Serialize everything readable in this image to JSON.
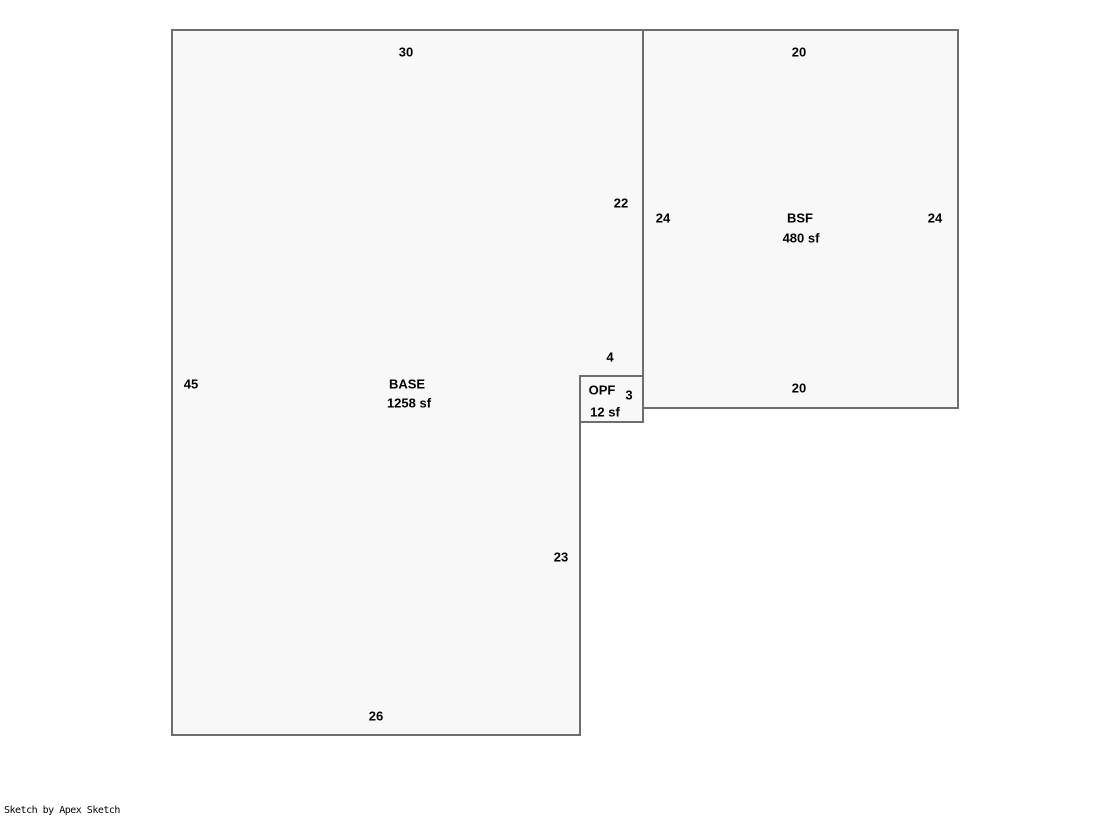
{
  "canvas": {
    "width": 1119,
    "height": 821,
    "background": "#ffffff"
  },
  "sketch": {
    "style": {
      "outline_color": "#6e6e6e",
      "fill_color": "#f8f8f8",
      "label_color": "#000000",
      "stroke_width": 2
    },
    "areas": [
      {
        "name": "base-area",
        "label": "BASE",
        "area_label": "1258 sf",
        "label_pos": {
          "x": 407,
          "y": 384
        },
        "area_label_pos": {
          "x": 409,
          "y": 403
        },
        "points": [
          [
            172,
            30
          ],
          [
            643,
            30
          ],
          [
            643,
            376
          ],
          [
            580,
            376
          ],
          [
            580,
            735
          ],
          [
            172,
            735
          ]
        ]
      },
      {
        "name": "bsf-area",
        "label": "BSF",
        "area_label": "480 sf",
        "label_pos": {
          "x": 800,
          "y": 218
        },
        "area_label_pos": {
          "x": 801,
          "y": 238
        },
        "points": [
          [
            643,
            30
          ],
          [
            958,
            30
          ],
          [
            958,
            408
          ],
          [
            643,
            408
          ]
        ]
      },
      {
        "name": "opf-area",
        "label": "OPF",
        "area_label": "12 sf",
        "label_pos": {
          "x": 602,
          "y": 390
        },
        "area_label_pos": {
          "x": 605,
          "y": 412
        },
        "points": [
          [
            580,
            376
          ],
          [
            643,
            376
          ],
          [
            643,
            422
          ],
          [
            580,
            422
          ]
        ]
      }
    ],
    "dimensions": [
      {
        "edge": "base-top",
        "value": "30",
        "x": 406,
        "y": 52
      },
      {
        "edge": "base-left",
        "value": "45",
        "x": 191,
        "y": 384
      },
      {
        "edge": "base-right-upper",
        "value": "22",
        "x": 621,
        "y": 203
      },
      {
        "edge": "base-step",
        "value": "4",
        "x": 610,
        "y": 357
      },
      {
        "edge": "base-right-lower",
        "value": "23",
        "x": 561,
        "y": 557
      },
      {
        "edge": "base-bottom",
        "value": "26",
        "x": 376,
        "y": 716
      },
      {
        "edge": "bsf-top",
        "value": "20",
        "x": 799,
        "y": 52
      },
      {
        "edge": "bsf-left",
        "value": "24",
        "x": 663,
        "y": 218
      },
      {
        "edge": "bsf-right",
        "value": "24",
        "x": 935,
        "y": 218
      },
      {
        "edge": "bsf-bottom",
        "value": "20",
        "x": 799,
        "y": 388
      },
      {
        "edge": "opf-right",
        "value": "3",
        "x": 629,
        "y": 395
      }
    ]
  },
  "footer": {
    "credit": "Sketch by Apex Sketch"
  }
}
